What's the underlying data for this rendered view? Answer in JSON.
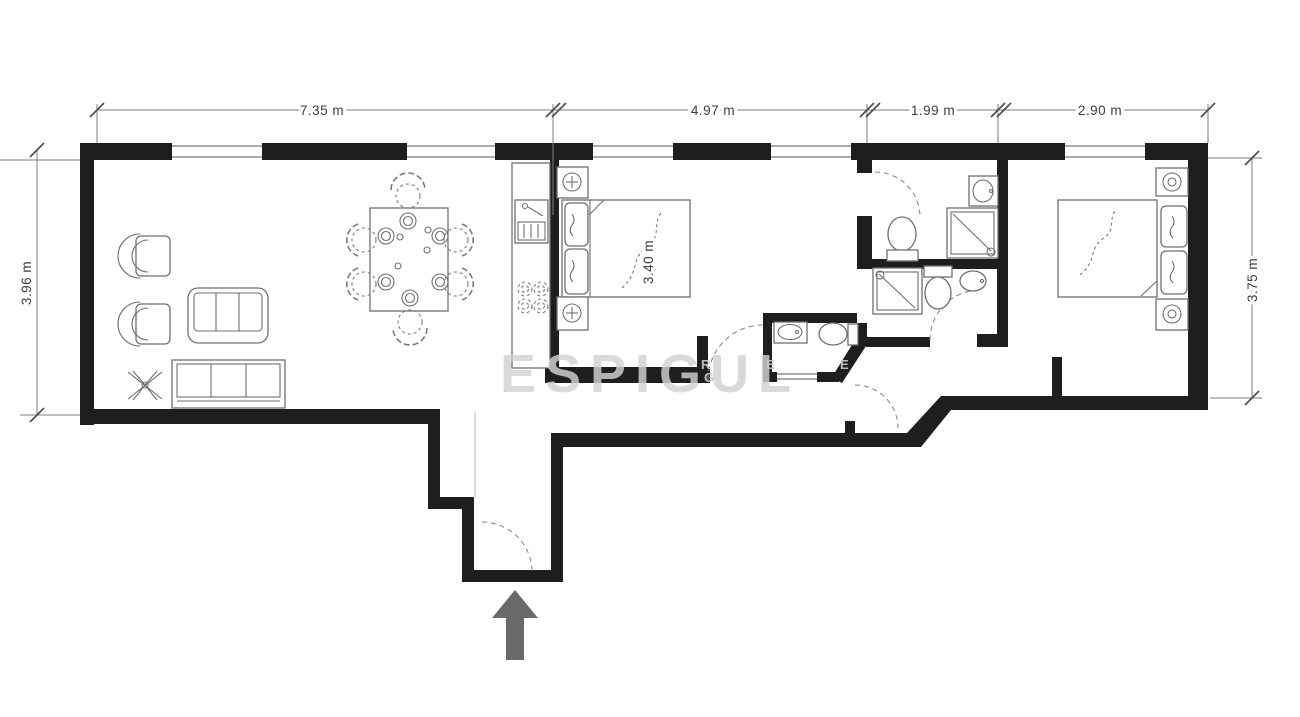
{
  "plan": {
    "type": "apartment-floor-plan",
    "dimensions": {
      "top": [
        {
          "label": "7.35 m"
        },
        {
          "label": "4.97 m"
        },
        {
          "label": "1.99 m"
        },
        {
          "label": "2.90 m"
        }
      ],
      "left": {
        "label": "3.96 m"
      },
      "right": {
        "label": "3.75 m"
      },
      "bed": {
        "label": "3.40 m"
      }
    },
    "watermark": {
      "text": "ESPIGUL",
      "fragments": [
        "R",
        "E",
        "G",
        "E"
      ]
    },
    "entrance": {
      "symbol": "up-arrow"
    },
    "colors": {
      "wall": "#1e1e1e",
      "furniture_outline": "#6f6f6f",
      "dimension_text": "#3d3d3d",
      "arrow": "#6a6a6a",
      "watermark": "#d2d2d2"
    }
  }
}
